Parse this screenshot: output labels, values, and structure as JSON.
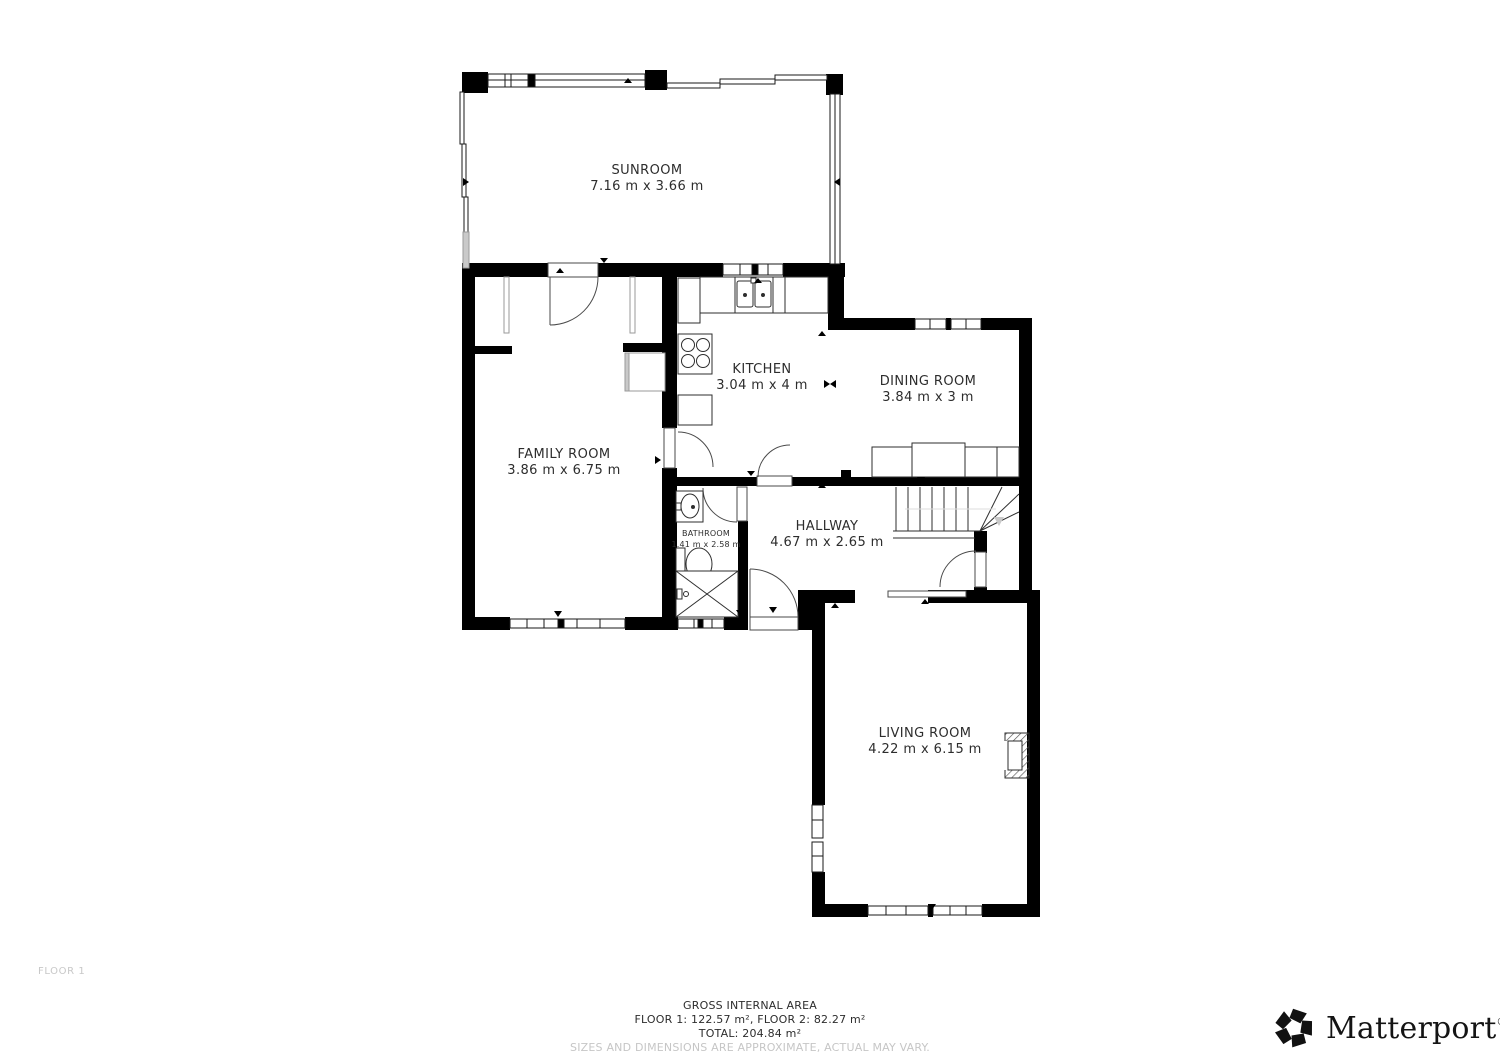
{
  "rooms": {
    "sunroom": {
      "name": "SUNROOM",
      "dims": "7.16 m x 3.66 m"
    },
    "kitchen": {
      "name": "KITCHEN",
      "dims": "3.04 m x 4 m"
    },
    "dining_room": {
      "name": "DINING ROOM",
      "dims": "3.84 m x 3 m"
    },
    "family_room": {
      "name": "FAMILY ROOM",
      "dims": "3.86 m x 6.75 m"
    },
    "hallway": {
      "name": "HALLWAY",
      "dims": "4.67 m x 2.65 m"
    },
    "bathroom": {
      "name": "BATHROOM",
      "dims": "1.41 m x 2.58 m"
    },
    "living_room": {
      "name": "LIVING ROOM",
      "dims": "4.22 m x 6.15 m"
    }
  },
  "floor_label": "FLOOR 1",
  "footer": {
    "title": "GROSS INTERNAL AREA",
    "floors": "FLOOR 1: 122.57 m², FLOOR 2: 82.27 m²",
    "total": "TOTAL: 204.84 m²",
    "disclaimer": "SIZES AND DIMENSIONS ARE APPROXIMATE, ACTUAL MAY VARY."
  },
  "brand": {
    "name": "Matterport",
    "registered": "®"
  },
  "colors": {
    "wall": "#000000",
    "fixture_line": "#2e2e2e",
    "muted": "#c8c8c8",
    "label": "#2d2d2d"
  }
}
